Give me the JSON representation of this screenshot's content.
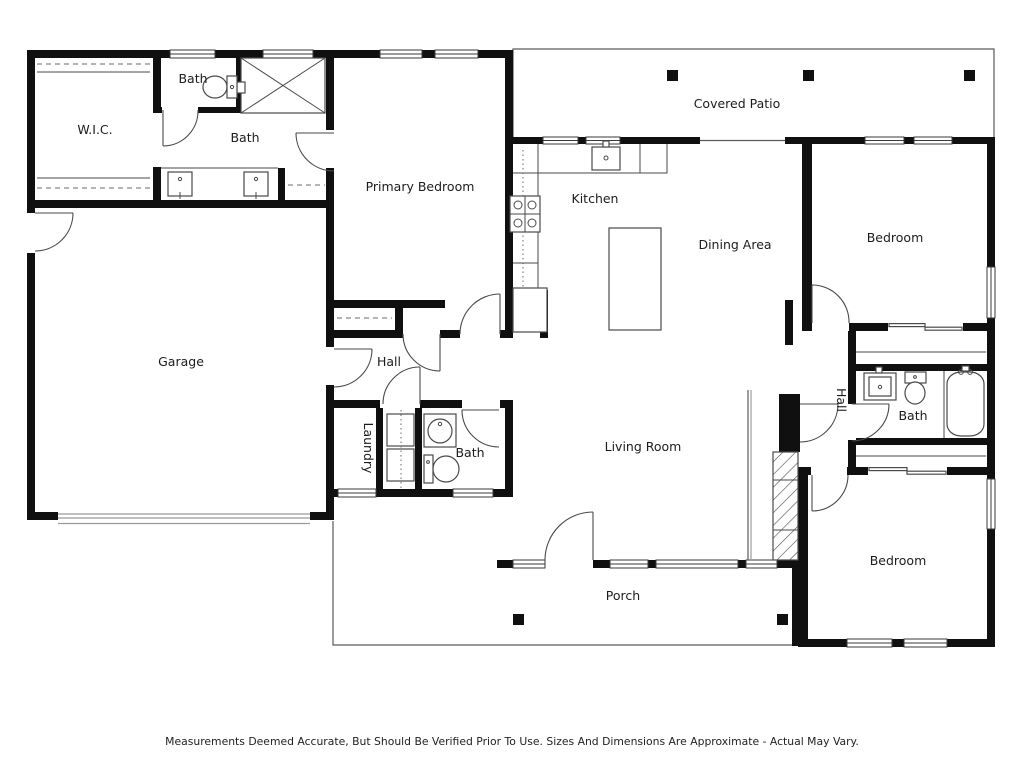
{
  "rooms": {
    "wic": "W.I.C.",
    "bath_top": "Bath",
    "bath_primary": "Bath",
    "primary_bedroom": "Primary Bedroom",
    "covered_patio": "Covered Patio",
    "kitchen": "Kitchen",
    "dining_area": "Dining Area",
    "bedroom_ne": "Bedroom",
    "garage": "Garage",
    "hall_center": "Hall",
    "laundry": "Laundry",
    "bath_center": "Bath",
    "living_room": "Living Room",
    "hall_east": "Hall",
    "bath_east": "Bath",
    "bedroom_se": "Bedroom",
    "porch": "Porch"
  },
  "footer": {
    "text": "Measurements Deemed Accurate, But Should Be Verified Prior To Use. Sizes And Dimensions Are Approximate - Actual May Vary."
  },
  "colors": {
    "wall": "#101010",
    "fixture_line": "#4a4a4a",
    "background": "#ffffff"
  }
}
